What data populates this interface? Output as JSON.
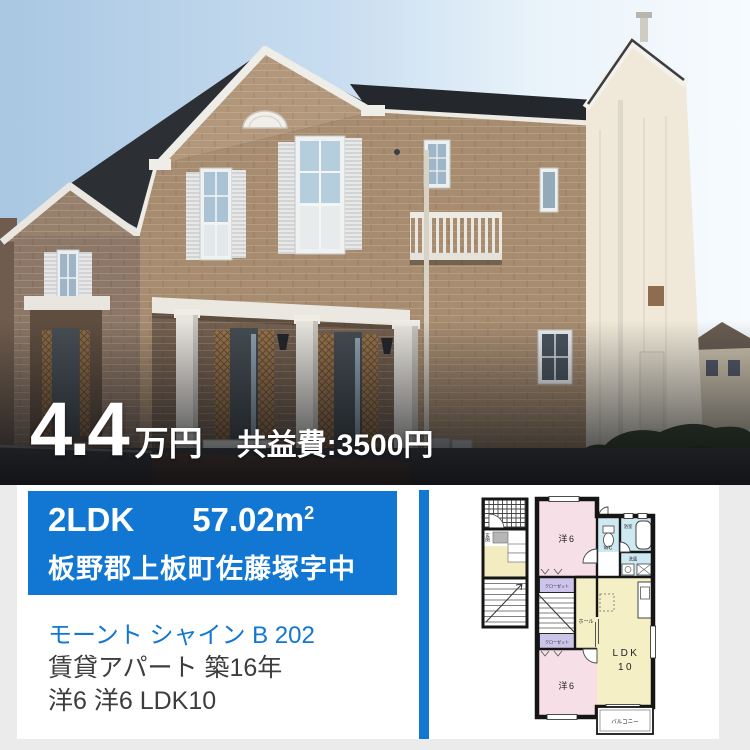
{
  "photo": {
    "description": "two-story beige brick apartment building exterior, blue sky",
    "price_value": "4.4",
    "price_unit": "万円",
    "fee": "共益費:3500円"
  },
  "info": {
    "layout": "2LDK",
    "area": "57.02",
    "area_unit": "m",
    "area_sup": "2",
    "address": "板野郡上板町佐藤塚字中",
    "name": "モーント シャイン B 202",
    "building": "賃貸アパート 築16年",
    "rooms": "洋6 洋6 LDK10"
  },
  "floorplan": {
    "labels": {
      "room_top": "洋6",
      "room_bottom": "洋6",
      "ldk": "LDK",
      "ldk_num": "10",
      "wc": "WC",
      "bath": "浴室",
      "wash": "洗面",
      "closet_top": "クローゼット",
      "closet_bottom": "クローゼット",
      "hall": "ホール",
      "entrance": "玄関",
      "balcony": "バルコニー"
    },
    "colors": {
      "room_pink": "#f7dfe8",
      "ldk_yellow": "#f5efc5",
      "wet_blue": "#cfe9f2",
      "closet_purple": "#ccc5e9",
      "wall": "#151515"
    }
  },
  "colors": {
    "accent_blue": "#1277d2",
    "page_bg": "#ebebeb",
    "card_bg": "#ffffff",
    "price_text": "#ffffff",
    "body_text": "#3d3d3d"
  }
}
